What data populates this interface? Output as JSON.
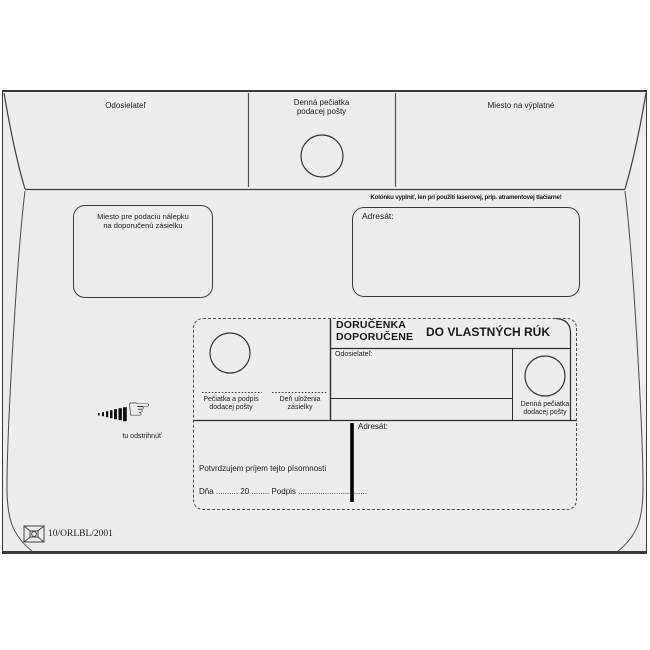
{
  "colors": {
    "envelope_fill": "#ededed",
    "line_color": "#3d3d3d",
    "text_color": "#1a1a1a"
  },
  "top_band": {
    "sender_label": "Odosielateľ",
    "posting_stamp_label_line1": "Denná pečiatka",
    "posting_stamp_label_line2": "podacej pošty",
    "postage_label": "Miesto na výplatné"
  },
  "middle": {
    "registration_sticker_line1": "Miesto pre podaciu nálepku",
    "registration_sticker_line2": "na doporučenú zásielku",
    "printer_note": "Kolónku vyplniť, len pri použití laserovej, príp. atramentovej tlačiarne!",
    "addressee_label": "Adresát:"
  },
  "delivery_card": {
    "title_line1": "DORUČENKA",
    "title_line2": "DOPORUČENE",
    "title_right": "DO VLASTNÝCH RÚK",
    "sender_label": "Odosielateľ:",
    "stamp_signature_line1": "Pečiatka a podpis",
    "stamp_signature_line2": "dodacej pošty",
    "deposit_day_line1": "Deň uloženia",
    "deposit_day_line2": "zásielky",
    "delivery_stamp_line1": "Denná pečiatka",
    "delivery_stamp_line2": "dodacej pošty",
    "addressee_label": "Adresát:",
    "confirmation_text": "Potvrdzujem príjem tejto písomnosti",
    "date_signature_line": "Dňa .......... 20 ........ Podpis ..............................."
  },
  "cut_mark": {
    "hand_glyph": "☞",
    "label": "tu odstrihnúť"
  },
  "footer": {
    "form_code": "10/ORLBL/2001"
  }
}
